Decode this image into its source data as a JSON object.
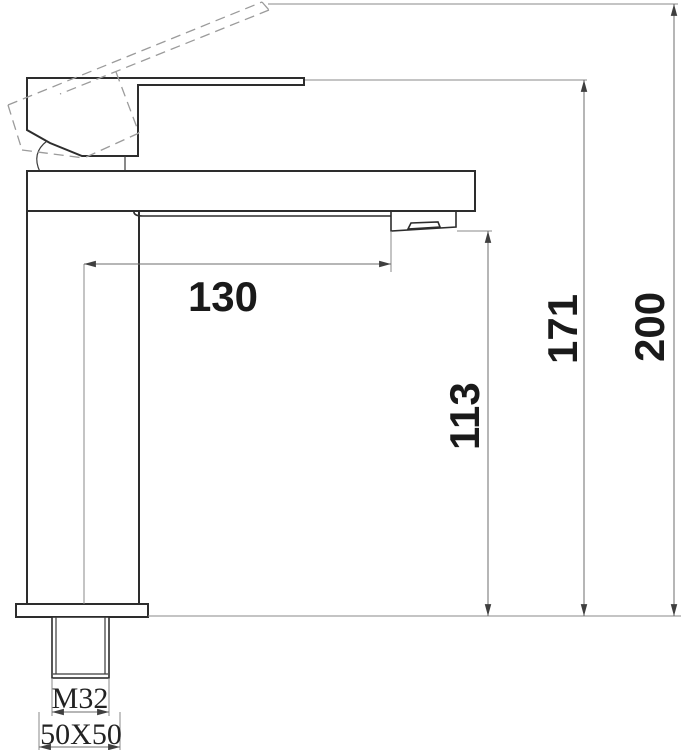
{
  "drawing": {
    "ink_color": "#2d2d2d",
    "dim_line_color": "#6e6e6e",
    "labels": {
      "spout_reach": "130",
      "spout_outlet_height": "113",
      "height_handle_closed": "171",
      "height_handle_raised": "200",
      "thread_spec": "M32",
      "base_footprint": "50X50"
    }
  }
}
